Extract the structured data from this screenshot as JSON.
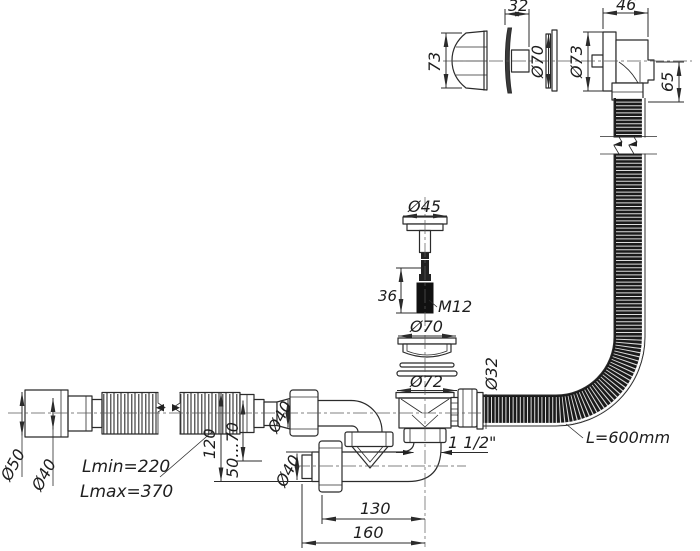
{
  "drawing": {
    "title": "Bath waste-overflow siphon dimensional drawing",
    "labels": {
      "knob_height": "73",
      "rosette_width": "32",
      "plate_diameter": "Ø70",
      "flange_diameter": "Ø73",
      "body_width": "46",
      "overflow_drop": "65",
      "plug_cap_diameter": "Ø45",
      "stud_length": "36",
      "thread_size": "M12",
      "strainer_diameter": "Ø70",
      "drain_hole_diameter": "Ø72",
      "overflow_hose_diameter": "Ø32",
      "outlet_thread": "1 1/2\"",
      "overflow_hose_length": "L=600mm",
      "offset_130": "130",
      "offset_160": "160",
      "pipe_min_length": "Lmin=220",
      "pipe_max_length": "Lmax=370",
      "cuff_diameter": "Ø50",
      "cuff_inner_diameter": "Ø40",
      "inlet_diameter": "Ø40",
      "lower_pipe_diameter": "Ø40",
      "drop_height": "120",
      "adjust_range": "50...70"
    },
    "colors": {
      "line": "#2b2b2b",
      "hose": "#1b1b1b",
      "background": "#ffffff"
    }
  }
}
